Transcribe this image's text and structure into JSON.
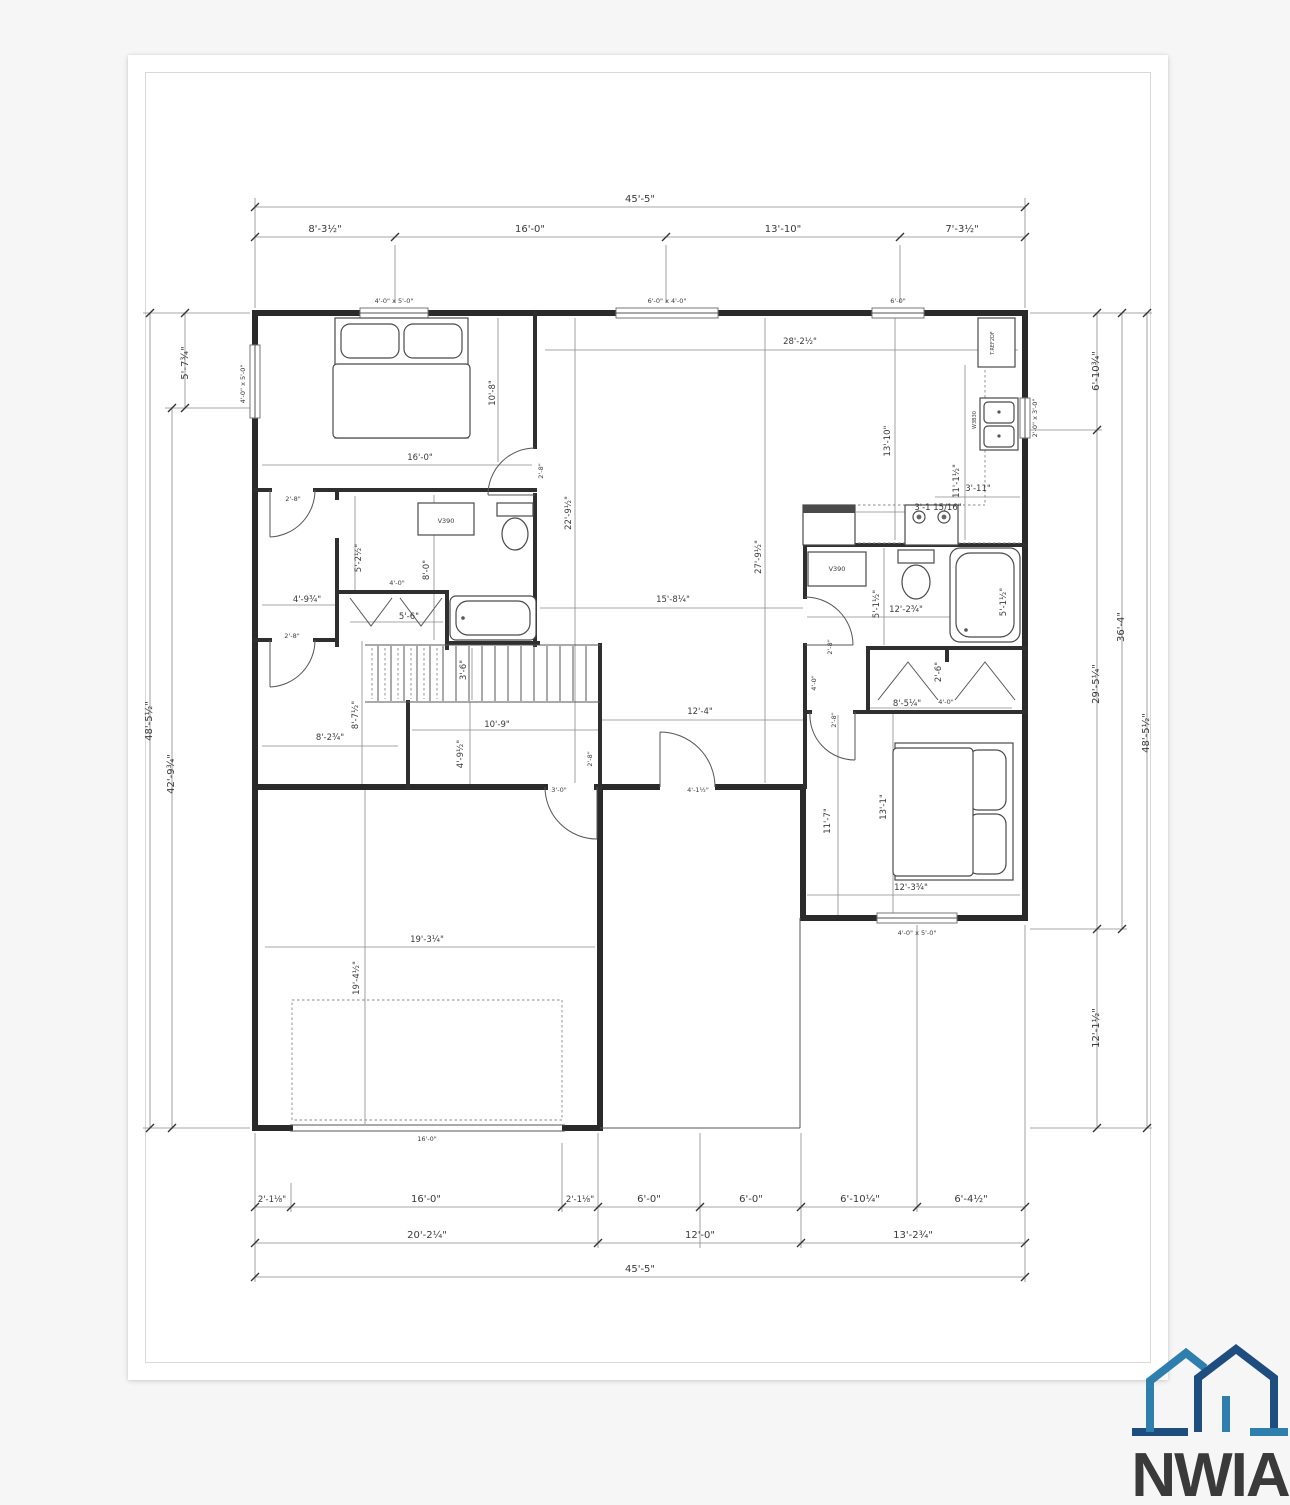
{
  "logo": {
    "text": "NWIA",
    "light_blue": "#2e7fad",
    "dark_blue": "#1e4e7f",
    "text_blue": "#1d4a78"
  },
  "windows": {
    "top1": "4'-0\" x 5'-0\"",
    "top2": "6'-0\" x 4'-0\"",
    "top3": "6'-0\"",
    "left": "4'-0\" x 5'-0\"",
    "right": "2'-0\" x 3'-0\"",
    "bed2": "4'-0\" x 5'-0\""
  },
  "fixtures": {
    "vanity1": "V390",
    "vanity2": "V390",
    "fridge": "T.REF2DF",
    "sink": "W3B30"
  },
  "dims": {
    "top": {
      "total": "45'-5\"",
      "seg": [
        "8'-3½\"",
        "16'-0\"",
        "13'-10\"",
        "7'-3½\""
      ]
    },
    "bottom": {
      "seg1": [
        "2'-1⅛\"",
        "16'-0\"",
        "2'-1⅛\"",
        "6'-0\"",
        "6'-0\"",
        "6'-10¼\"",
        "6'-4½\""
      ],
      "seg2": [
        "20'-2¼\"",
        "12'-0\"",
        "13'-2¾\""
      ],
      "total": "45'-5\""
    },
    "left": {
      "top": "5'-7¾\"",
      "inner": "42'-9¾\"",
      "total": "48'-5½\""
    },
    "right": {
      "top": "6'-10¾\"",
      "mid": "29'-5¼\"",
      "inner": "36'-4\"",
      "total": "48'-5½\"",
      "bottom": "12'-1½\""
    },
    "master": {
      "w": "16'-0\"",
      "h": "10'-8\"",
      "door": "2'-8\""
    },
    "great": {
      "w": "28'-2½\"",
      "h1": "22'-9½\"",
      "h2": "27'-9½\"",
      "mid": "15'-8¼\"",
      "hall": "12'-4\""
    },
    "kitchen": {
      "h": "13'-10\"",
      "counter": "11'-1½\"",
      "d1": "3'-11\"",
      "d2": "3'-1 15/16\""
    },
    "bath1": {
      "d1": "5'-2½\"",
      "d2": "8'-0\"",
      "closet_d": "4'-0\"",
      "closet_w": "5'-6\"",
      "d3": "4'-9¾\"",
      "door": "2'-8\"",
      "door2": "2'-8\""
    },
    "stairs": {
      "w": "3'-6\"",
      "d1": "8'-7½\"",
      "d2": "8'-2¾\"",
      "d3": "10'-9\"",
      "d4": "4'-9½\"",
      "door": "3'-0\"",
      "door2": "2'-8\""
    },
    "entry": {
      "door": "4'-1½\""
    },
    "bath2": {
      "w": "12'-2¾\"",
      "h1": "5'-1½\"",
      "h2": "5'-1½\"",
      "door": "2'-8\"",
      "hall": "4'-0\"",
      "closet": "2'-6\"",
      "closet_w": "8'-5¼\"",
      "closet_d": "4'-0\""
    },
    "bed2": {
      "h1": "11'-7\"",
      "h2": "13'-1\"",
      "w": "12'-3¾\"",
      "door": "2'-8\""
    },
    "garage": {
      "w": "19'-3¼\"",
      "h": "19'-4½\"",
      "door": "16'-0\""
    }
  }
}
